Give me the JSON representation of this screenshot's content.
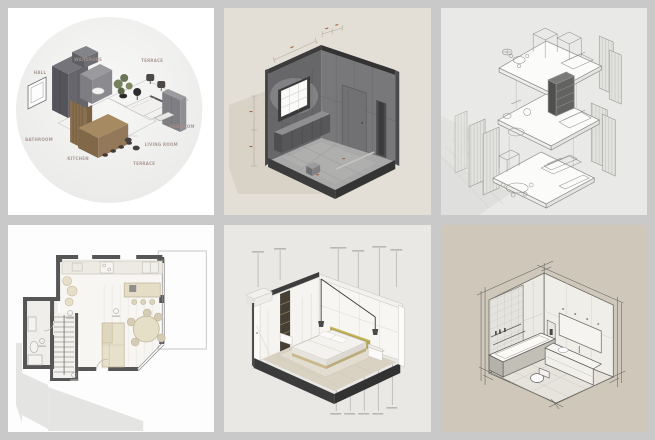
{
  "canvas": {
    "width": 655,
    "height": 440,
    "background": "#c9c9c9"
  },
  "gallery": {
    "tiles": [
      {
        "name": "exploded-apartment-axonometric",
        "background": "#ffffff",
        "circle_color": "#f0f0ef",
        "label_color": "#a5908a",
        "labels": {
          "hall": "HALL",
          "wardrobe": "WARDROBE",
          "terrace_top": "TERRACE",
          "bedroom": "BEDROOM",
          "living_room": "LIVING ROOM",
          "terrace_bottom": "TERRACE",
          "kitchen": "KITCHEN",
          "bathroom": "BATHROOM"
        }
      },
      {
        "name": "dark-gray-room-isometric",
        "background": "#e4dfd6",
        "wall_color": "#6b6b6d",
        "floor_color": "#a9a9a9",
        "trim_color": "#3c3c3c",
        "dimension_mark_color": "#a2643f"
      },
      {
        "name": "exploded-floor-levels-line-drawing",
        "background": "#e9e9e7",
        "line_color": "#8d8d8a",
        "plate_color": "#fbfbfa"
      },
      {
        "name": "ground-floor-plan",
        "background": "#fdfdfd",
        "wall_color": "#565656",
        "furniture_color": "#e5ddc5",
        "shadow_color": "#e4e4e2"
      },
      {
        "name": "bedroom-cutaway-isometric",
        "background": "#e9e8e5",
        "frame_color": "#3b3b3b",
        "floor_color": "#d9d1c2",
        "headboard_color": "#b3a54d"
      },
      {
        "name": "bathroom-sketch-isometric",
        "background": "#cfc7ba",
        "line_color": "#5f5e5a",
        "wall_color": "#eceae4"
      }
    ]
  }
}
